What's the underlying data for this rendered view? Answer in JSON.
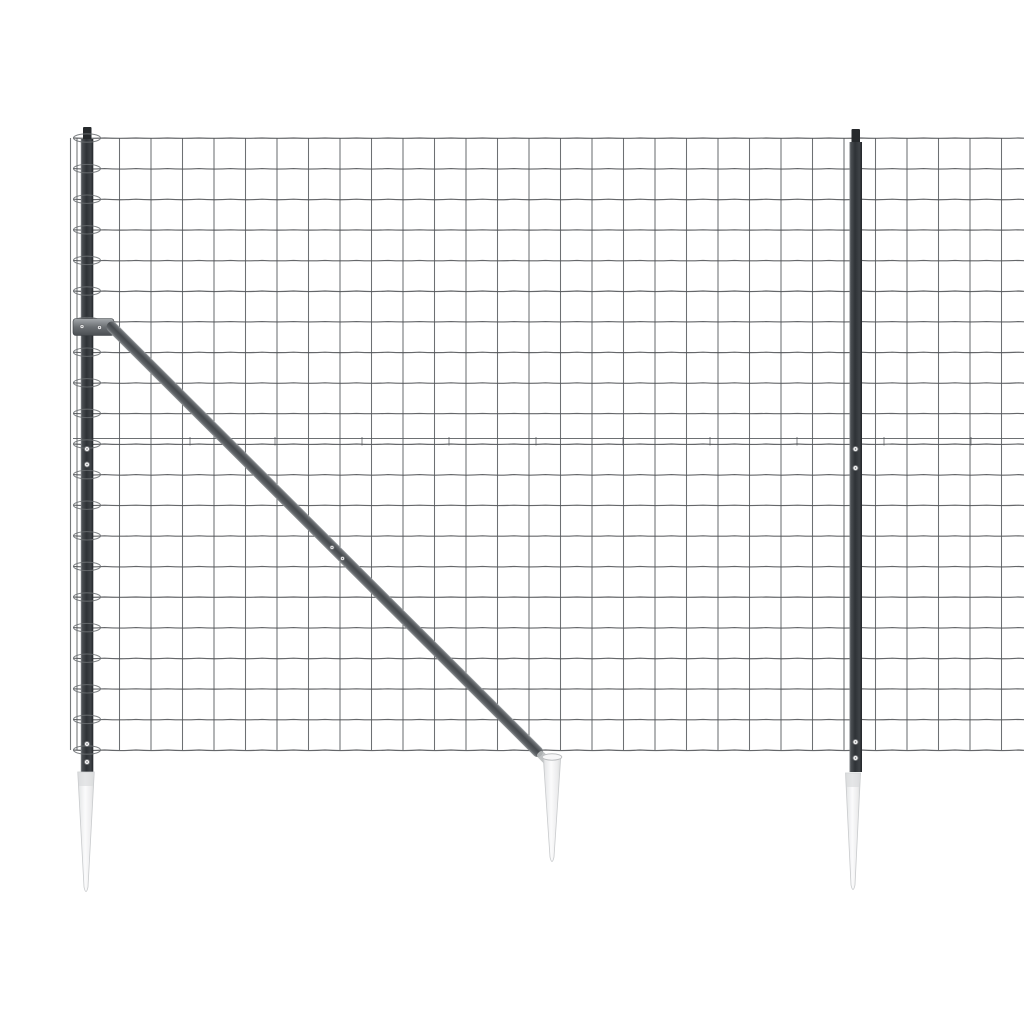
{
  "colors": {
    "background": "#ffffff",
    "wire": "#54575a",
    "loop": "#6a6e71",
    "post_gradient": [
      "#84888c",
      "#4a4e52",
      "#2e3236",
      "#3f4347",
      "#212428"
    ],
    "cap": "#26292c",
    "brace_gradient": [
      "#a4a8ab",
      "#6e7276",
      "#44484c",
      "#5d6165",
      "#8f9396"
    ],
    "brace_tip": "#b9bcbe",
    "clamp_gradient": [
      "#a6aaad",
      "#6b6f73",
      "#4a4e52"
    ],
    "spike_gradient": [
      "#cfd1d3",
      "#e8e9ea",
      "#fbfbfc",
      "#ececed",
      "#d8dadb"
    ],
    "spike_outline": "#c9cbcd",
    "spike_collar": "#d9dadc",
    "spike_rim": "#bdbfc1",
    "screw_fill": "#f2f2f3",
    "screw_ring": "#6a6d70"
  },
  "scene": {
    "canvas": {
      "w": 1024,
      "h": 1024
    },
    "mesh": {
      "x_start": 73,
      "x_end": 1032,
      "top": 138,
      "row_spacing": 30.6,
      "rows": 21,
      "col_start": 88,
      "col_spacing": 31.5,
      "extra_wire_y": 438.5,
      "tick_xs": [
        190,
        275,
        362,
        449,
        536,
        623,
        710,
        797,
        884,
        971
      ],
      "edge_wires_x": [
        70.5,
        77
      ],
      "wave": 0.9
    },
    "loops": {
      "cx": 87,
      "rx": 13.5,
      "ry": 4.2
    },
    "left_post": {
      "x": 80.8,
      "w": 12.5,
      "top": 139,
      "bottom": 773,
      "cap": {
        "x": 83,
        "y": 127,
        "w": 8.5,
        "h": 14
      }
    },
    "right_post": {
      "x": 849.5,
      "w": 12.5,
      "top": 142,
      "bottom": 772,
      "cap": {
        "x": 851.5,
        "y": 129,
        "w": 8.5,
        "h": 14
      }
    },
    "post_screws": [
      [
        87,
        449
      ],
      [
        87,
        464.5
      ],
      [
        87,
        744
      ],
      [
        87,
        762
      ],
      [
        855.5,
        449
      ],
      [
        855.5,
        468
      ],
      [
        855.5,
        742
      ],
      [
        855.5,
        758
      ]
    ],
    "clamp": {
      "x": 73,
      "y": 318.5,
      "w": 41,
      "h": 17,
      "screws": [
        [
          82,
          326.5
        ],
        [
          99.5,
          327.5
        ]
      ]
    },
    "brace": {
      "x1": 111,
      "y1": 326,
      "x2": 540,
      "y2": 754,
      "w": 11,
      "screws": [
        [
          332,
          547.5
        ],
        [
          342.5,
          558.5
        ]
      ]
    },
    "spikes": [
      {
        "id": "left",
        "cx": 86,
        "top": 772,
        "tip": 895,
        "top_w": 16.5,
        "collar": true,
        "rim": false
      },
      {
        "id": "middle",
        "cx": 552,
        "top": 757,
        "tip": 865,
        "top_w": 17.5,
        "collar": false,
        "rim": true
      },
      {
        "id": "right",
        "cx": 853,
        "top": 773,
        "tip": 893,
        "top_w": 15,
        "collar": true,
        "rim": false
      }
    ]
  }
}
